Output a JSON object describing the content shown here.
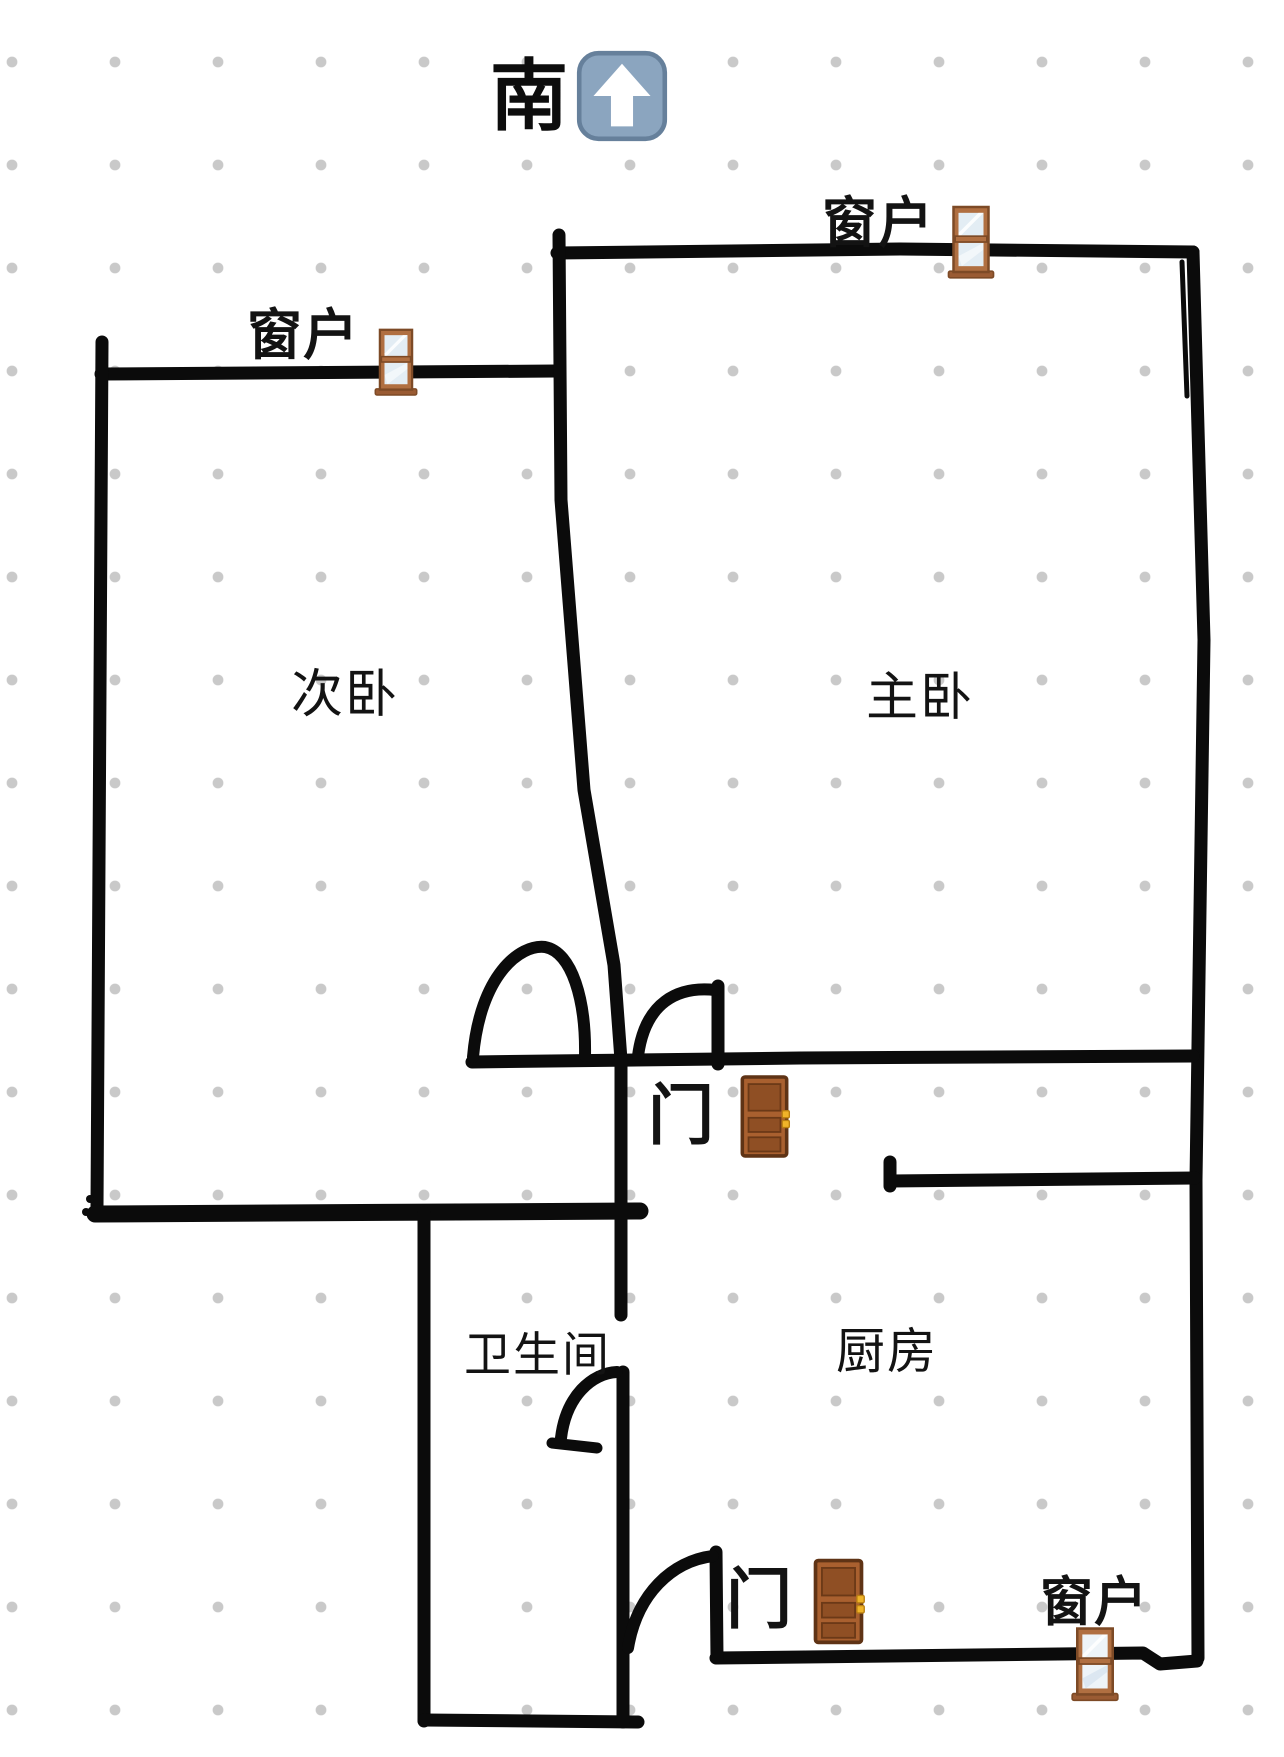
{
  "compass": {
    "direction_label": "南",
    "arrow_icon": "up-arrow-emoji"
  },
  "rooms": {
    "secondary_bedroom": "次卧",
    "master_bedroom": "主卧",
    "bathroom": "卫生间",
    "kitchen": "厨房"
  },
  "labels": {
    "window": "窗户",
    "door": "门"
  },
  "icons": {
    "window": "window-emoji",
    "door": "door-emoji",
    "arrow": "up-arrow-emoji"
  },
  "colors": {
    "background": "#ffffff",
    "grid_dot": "#c9c9c9",
    "wall": "#0b0b0b",
    "text": "#131313",
    "window_frame": "#b06f41",
    "window_glass": "#e3edf4",
    "door_body": "#a9602f",
    "door_outline": "#5f3315",
    "door_handle": "#f0b429",
    "arrow_square": "#8ba5bf",
    "arrow_border": "#66809b",
    "arrow_glyph": "#ffffff"
  }
}
